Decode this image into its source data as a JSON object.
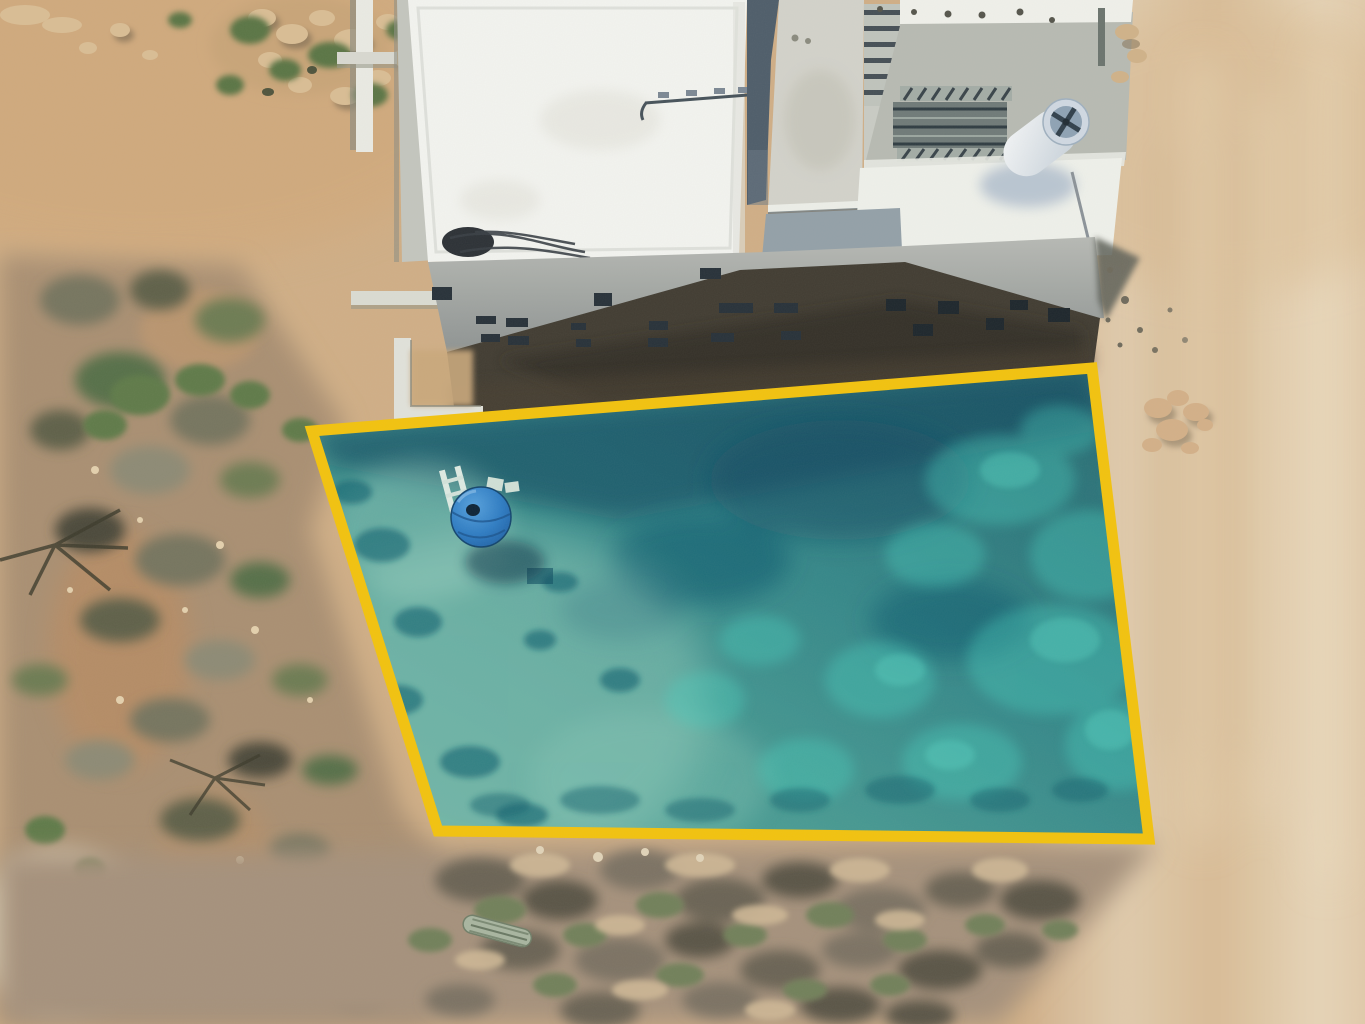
{
  "meta": {
    "type": "aerial-drone-photograph",
    "description": "Top-down drone photo of a vacant desert lot for sale, highlighted with a translucent teal overlay and bold yellow boundary, beside a white concrete house under construction; sandy graded dirt on the right, dense desert scrub on the left and bottom."
  },
  "photo": {
    "width": "1365",
    "height": "1024"
  },
  "lot_overlay": {
    "boundary_points": "312,431 1092,368 1149,839 438,831",
    "corner_top_left": "312,431",
    "corner_top_right": "1092,368",
    "corner_bottom_right": "1149,839",
    "corner_bottom_left": "438,831",
    "fill_color": "#2e8f90",
    "fill_opacity": "0.32",
    "border_color": "#f2c20e",
    "border_width": "11"
  },
  "water_tank": {
    "cx": "481",
    "cy": "517",
    "r": "30",
    "color": "#2e7cc3"
  },
  "building": {
    "roof_white": "#f2f3ef",
    "concrete_terrace": "#b7bab2",
    "middle_roof": "#d2d2ca",
    "facade_grey": "#a0a5a3",
    "window_dark": "#273139",
    "shadow_dark": "#413c32",
    "groove_slate": "#4e5d6a",
    "water_heater_body": "#e9eef2"
  },
  "terrain": {
    "dirt_base": "#cfae86",
    "dirt_right_light": "#dcc3a2",
    "dirt_orange": "#c08a5c",
    "scrub_base": "#a98f72",
    "scrub_dark": "#5f6048",
    "scrub_green": "#657c4f",
    "rock_light": "#d9bd94"
  },
  "objects": {
    "lot_overlay": "highlighted parcel boundary",
    "water_tank": "blue plastic water tank inside lot",
    "ladder": "white ladder beside tank",
    "house": "white flat-roof house under construction",
    "solar_heater": "white cylindrical water heater on roof walkway",
    "stairs": "concrete stairs on roof terrace",
    "rocks": "stone cluster on graded dirt",
    "fallen_cactus": "fallen cactus log in bottom scrub"
  }
}
